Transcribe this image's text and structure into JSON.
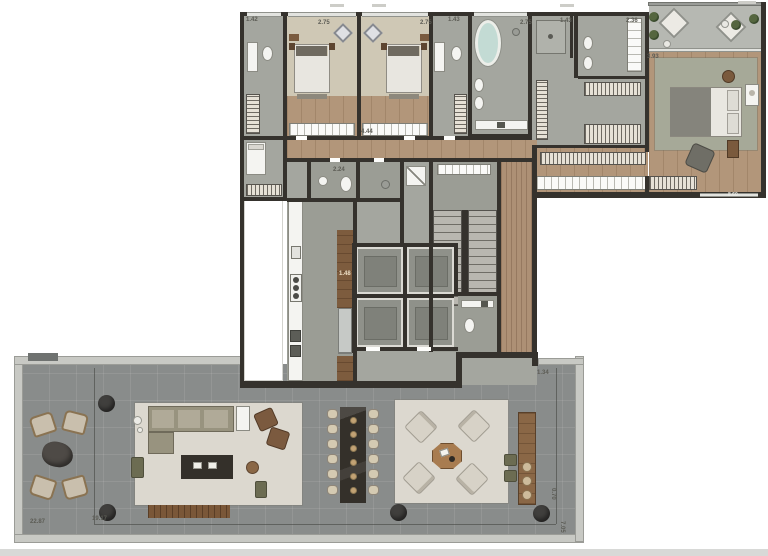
{
  "plan": {
    "type": "residential floor plan with terrace",
    "colors": {
      "wall": "#35322d",
      "wood_floor": "#b2967a",
      "bedroom_carpet": "#cfc8b5",
      "bath_tile": "#a4a69f",
      "terrace_deck": "#898c8b",
      "terrace_frame": "#c8c9c4",
      "master_rug": "#a6a998",
      "outdoor_rug": "#dcd8cf",
      "furniture_brown": "#7d5c3e",
      "dark_table": "#34302a",
      "tub_water": "#c3dbd4",
      "plant_green": "#45523a"
    }
  },
  "dimension_labels": [
    {
      "text": "1.42"
    },
    {
      "text": "2.75"
    },
    {
      "text": "2.75"
    },
    {
      "text": "1.43"
    },
    {
      "text": "2.75"
    },
    {
      "text": "1.43"
    },
    {
      "text": "2.36"
    },
    {
      "text": "3.93"
    },
    {
      "text": "8.60"
    },
    {
      "text": "4.44"
    },
    {
      "text": "2.24"
    },
    {
      "text": "1.48"
    },
    {
      "text": "1.34"
    },
    {
      "text": "22.87"
    },
    {
      "text": "19.17"
    },
    {
      "text": "0.70"
    },
    {
      "text": "7.05"
    }
  ]
}
